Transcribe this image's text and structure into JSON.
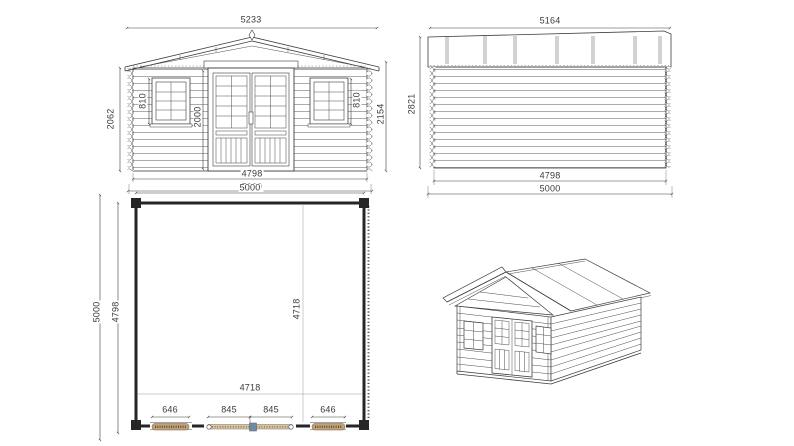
{
  "drawing": {
    "title": "Log cabin technical drawing",
    "colors": {
      "line": "#3d3d3d",
      "wall_heavy": "#262626",
      "hatch_tan": "#c2a379",
      "door_tan": "#d8c7a6",
      "marker_blue": "#7289a4",
      "hatch_stroke": "#6b5b43"
    },
    "views": {
      "front_elevation": {
        "name": "Front elevation",
        "dims": {
          "roof_width": "5233",
          "wall_height": "2062",
          "window_left_height": "810",
          "door_height": "2000",
          "window_right_height": "810",
          "eave_height": "2154",
          "wall_width": "4798",
          "base_width": "5000"
        }
      },
      "side_elevation": {
        "name": "Side elevation",
        "dims": {
          "roof_length": "5164",
          "total_height": "2821",
          "wall_length": "4798",
          "base_length": "5000"
        }
      },
      "floor_plan": {
        "name": "Floor plan",
        "dims": {
          "width_top": "5000",
          "depth_outer": "5000",
          "depth_inner": "4798",
          "interior_width": "4718",
          "interior_depth": "4718",
          "window_left_width": "646",
          "door_leaf_left": "845",
          "door_leaf_right": "845",
          "window_right_width": "646"
        }
      },
      "perspective": {
        "name": "3D view"
      }
    }
  }
}
